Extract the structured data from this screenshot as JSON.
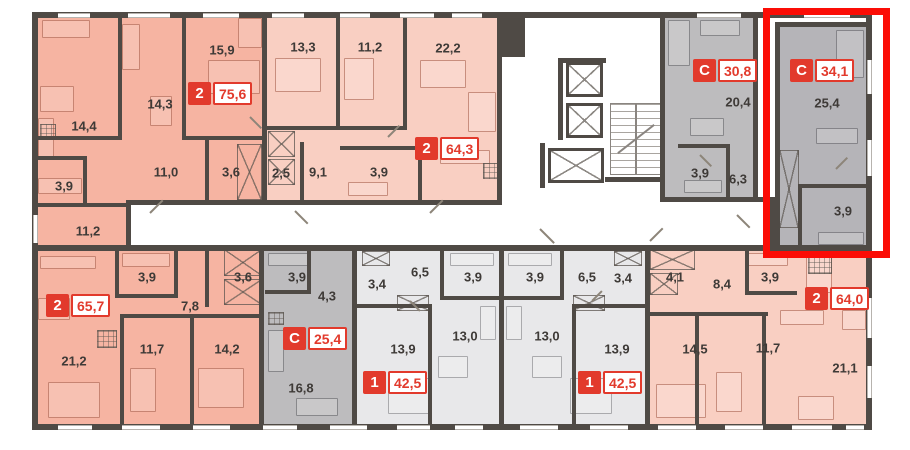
{
  "plan_title": "apartment-floor-plan",
  "palettes": {
    "salmon": "#f6b4a2",
    "pink": "#f9cfc2",
    "gray": "#bdbcbe",
    "gray2": "#b5b4b8",
    "light": "#e8e8ea",
    "wall": "#4f4a45",
    "badge_red": "#e23a2c",
    "highlight_red": "#fb0d06"
  },
  "apartments": [
    {
      "id": "a1",
      "type": "2",
      "area": "75,6",
      "palette": "salmon",
      "regions": [
        {
          "x": 35,
          "y": 15,
          "w": 227,
          "h": 190
        },
        {
          "x": 35,
          "y": 200,
          "w": 91,
          "h": 46
        }
      ],
      "badge": {
        "x": 188,
        "y": 82
      },
      "rooms": [
        {
          "t": "15,9",
          "x": 222,
          "y": 50
        },
        {
          "t": "14,3",
          "x": 160,
          "y": 104
        },
        {
          "t": "14,4",
          "x": 84,
          "y": 126
        },
        {
          "t": "11,0",
          "x": 166,
          "y": 172
        },
        {
          "t": "3,6",
          "x": 231,
          "y": 172
        },
        {
          "t": "3,9",
          "x": 64,
          "y": 186
        },
        {
          "t": "11,2",
          "x": 88,
          "y": 231
        }
      ]
    },
    {
      "id": "a2",
      "type": "2",
      "area": "64,3",
      "palette": "pink",
      "regions": [
        {
          "x": 267,
          "y": 15,
          "w": 230,
          "h": 190
        }
      ],
      "badge": {
        "x": 415,
        "y": 137
      },
      "rooms": [
        {
          "t": "13,3",
          "x": 303,
          "y": 47
        },
        {
          "t": "11,2",
          "x": 370,
          "y": 47
        },
        {
          "t": "22,2",
          "x": 448,
          "y": 48
        },
        {
          "t": "2,5",
          "x": 281,
          "y": 173
        },
        {
          "t": "9,1",
          "x": 318,
          "y": 172
        },
        {
          "t": "3,9",
          "x": 379,
          "y": 172
        }
      ]
    },
    {
      "id": "a3",
      "type": "С",
      "area": "30,8",
      "palette": "gray",
      "regions": [
        {
          "x": 665,
          "y": 15,
          "w": 88,
          "h": 185
        }
      ],
      "badge": {
        "x": 693,
        "y": 59
      },
      "rooms": [
        {
          "t": "20,4",
          "x": 738,
          "y": 102
        },
        {
          "t": "3,9",
          "x": 700,
          "y": 173
        },
        {
          "t": "6,3",
          "x": 738,
          "y": 179
        }
      ]
    },
    {
      "id": "a4",
      "type": "С",
      "area": "34,1",
      "palette": "gray2",
      "regions": [
        {
          "x": 780,
          "y": 27,
          "w": 86,
          "h": 219
        }
      ],
      "badge": {
        "x": 790,
        "y": 59
      },
      "rooms": [
        {
          "t": "25,4",
          "x": 827,
          "y": 103
        },
        {
          "t": "3,9",
          "x": 843,
          "y": 211
        }
      ]
    },
    {
      "id": "a5",
      "type": "2",
      "area": "65,7",
      "palette": "salmon",
      "regions": [
        {
          "x": 35,
          "y": 251,
          "w": 224,
          "h": 173
        }
      ],
      "badge": {
        "x": 46,
        "y": 294
      },
      "rooms": [
        {
          "t": "3,9",
          "x": 147,
          "y": 277
        },
        {
          "t": "3,6",
          "x": 243,
          "y": 277
        },
        {
          "t": "7,8",
          "x": 190,
          "y": 306
        },
        {
          "t": "21,2",
          "x": 74,
          "y": 361
        },
        {
          "t": "11,7",
          "x": 152,
          "y": 349
        },
        {
          "t": "14,2",
          "x": 227,
          "y": 349
        }
      ]
    },
    {
      "id": "a6",
      "type": "С",
      "area": "25,4",
      "palette": "gray",
      "regions": [
        {
          "x": 264,
          "y": 251,
          "w": 88,
          "h": 173
        }
      ],
      "badge": {
        "x": 283,
        "y": 327
      },
      "rooms": [
        {
          "t": "3,9",
          "x": 297,
          "y": 277
        },
        {
          "t": "4,3",
          "x": 327,
          "y": 296
        },
        {
          "t": "16,8",
          "x": 301,
          "y": 388
        }
      ]
    },
    {
      "id": "a7",
      "type": "1",
      "area": "42,5",
      "palette": "light",
      "regions": [
        {
          "x": 357,
          "y": 251,
          "w": 142,
          "h": 173
        }
      ],
      "badge": {
        "x": 363,
        "y": 371
      },
      "rooms": [
        {
          "t": "6,5",
          "x": 420,
          "y": 272
        },
        {
          "t": "3,4",
          "x": 377,
          "y": 284
        },
        {
          "t": "3,9",
          "x": 473,
          "y": 277
        },
        {
          "t": "13,9",
          "x": 403,
          "y": 349
        },
        {
          "t": "13,0",
          "x": 465,
          "y": 336
        }
      ]
    },
    {
      "id": "a8",
      "type": "1",
      "area": "42,5",
      "palette": "light",
      "regions": [
        {
          "x": 504,
          "y": 251,
          "w": 141,
          "h": 173
        }
      ],
      "badge": {
        "x": 578,
        "y": 371
      },
      "rooms": [
        {
          "t": "3,9",
          "x": 535,
          "y": 277
        },
        {
          "t": "6,5",
          "x": 587,
          "y": 277
        },
        {
          "t": "3,4",
          "x": 623,
          "y": 278
        },
        {
          "t": "13,0",
          "x": 547,
          "y": 336
        },
        {
          "t": "13,9",
          "x": 617,
          "y": 349
        }
      ]
    },
    {
      "id": "a9",
      "type": "2",
      "area": "64,0",
      "palette": "pink",
      "regions": [
        {
          "x": 650,
          "y": 251,
          "w": 216,
          "h": 173
        }
      ],
      "badge": {
        "x": 805,
        "y": 287
      },
      "rooms": [
        {
          "t": "4,1",
          "x": 675,
          "y": 277
        },
        {
          "t": "8,4",
          "x": 722,
          "y": 284
        },
        {
          "t": "3,9",
          "x": 770,
          "y": 277
        },
        {
          "t": "14,5",
          "x": 695,
          "y": 349
        },
        {
          "t": "11,7",
          "x": 768,
          "y": 348
        },
        {
          "t": "21,1",
          "x": 845,
          "y": 368
        }
      ]
    }
  ],
  "highlight": {
    "x": 763,
    "y": 8,
    "w": 127,
    "h": 250
  },
  "core": {
    "elevators": [
      [
        566,
        62,
        37,
        35
      ],
      [
        566,
        103,
        37,
        35
      ],
      [
        548,
        148,
        56,
        35
      ]
    ],
    "stairs": [
      610,
      103,
      52,
      72
    ]
  },
  "walls": [
    [
      32,
      12,
      840,
      6
    ],
    [
      32,
      424,
      840,
      6
    ],
    [
      32,
      12,
      6,
      418
    ],
    [
      866,
      12,
      6,
      418
    ],
    [
      128,
      200,
      374,
      5
    ],
    [
      662,
      197,
      115,
      5
    ],
    [
      32,
      245,
      840,
      6
    ],
    [
      126,
      200,
      5,
      50
    ],
    [
      770,
      197,
      6,
      54
    ],
    [
      262,
      12,
      5,
      193
    ],
    [
      497,
      12,
      5,
      193
    ],
    [
      660,
      12,
      5,
      190
    ],
    [
      753,
      12,
      5,
      190
    ],
    [
      775,
      22,
      5,
      229
    ],
    [
      775,
      22,
      93,
      5
    ],
    [
      259,
      251,
      5,
      173
    ],
    [
      352,
      251,
      5,
      173
    ],
    [
      499,
      251,
      5,
      173
    ],
    [
      645,
      251,
      5,
      173
    ],
    [
      118,
      12,
      4,
      128
    ],
    [
      182,
      12,
      4,
      128
    ],
    [
      35,
      136,
      85,
      4
    ],
    [
      182,
      136,
      82,
      4
    ],
    [
      35,
      156,
      52,
      4
    ],
    [
      83,
      156,
      4,
      50
    ],
    [
      35,
      203,
      93,
      4
    ],
    [
      205,
      140,
      4,
      64
    ],
    [
      336,
      12,
      4,
      118
    ],
    [
      403,
      12,
      4,
      118
    ],
    [
      267,
      126,
      140,
      4
    ],
    [
      300,
      142,
      4,
      62
    ],
    [
      340,
      146,
      82,
      4
    ],
    [
      418,
      146,
      4,
      58
    ],
    [
      678,
      144,
      50,
      4
    ],
    [
      726,
      144,
      4,
      55
    ],
    [
      798,
      184,
      70,
      4
    ],
    [
      798,
      184,
      4,
      64
    ],
    [
      115,
      251,
      4,
      47
    ],
    [
      115,
      294,
      62,
      4
    ],
    [
      174,
      251,
      4,
      47
    ],
    [
      205,
      251,
      4,
      56
    ],
    [
      120,
      314,
      142,
      4
    ],
    [
      120,
      318,
      4,
      108
    ],
    [
      190,
      318,
      4,
      108
    ],
    [
      265,
      290,
      46,
      4
    ],
    [
      307,
      251,
      4,
      42
    ],
    [
      440,
      251,
      4,
      49
    ],
    [
      440,
      296,
      62,
      4
    ],
    [
      428,
      308,
      4,
      118
    ],
    [
      355,
      304,
      77,
      4
    ],
    [
      560,
      251,
      4,
      49
    ],
    [
      502,
      296,
      62,
      4
    ],
    [
      572,
      308,
      4,
      118
    ],
    [
      572,
      304,
      77,
      4
    ],
    [
      745,
      251,
      4,
      44
    ],
    [
      745,
      291,
      52,
      4
    ],
    [
      695,
      316,
      4,
      110
    ],
    [
      762,
      316,
      4,
      110
    ],
    [
      648,
      312,
      120,
      4
    ],
    [
      497,
      15,
      28,
      42
    ],
    [
      558,
      58,
      5,
      82
    ],
    [
      558,
      58,
      48,
      5
    ],
    [
      540,
      143,
      5,
      45
    ],
    [
      605,
      177,
      60,
      5
    ]
  ],
  "windows_top": [
    [
      58,
      32
    ],
    [
      128,
      42
    ],
    [
      203,
      36
    ],
    [
      272,
      32
    ],
    [
      340,
      30
    ],
    [
      400,
      34
    ],
    [
      452,
      30
    ],
    [
      697,
      44
    ],
    [
      804,
      46
    ]
  ],
  "windows_bottom": [
    [
      58,
      34
    ],
    [
      122,
      38
    ],
    [
      193,
      37
    ],
    [
      263,
      34
    ],
    [
      330,
      37
    ],
    [
      397,
      33
    ],
    [
      455,
      28
    ],
    [
      520,
      38
    ],
    [
      590,
      38
    ],
    [
      658,
      38
    ],
    [
      725,
      38
    ],
    [
      792,
      40
    ],
    [
      846,
      18
    ]
  ],
  "windows_left": [
    [
      215,
      28
    ]
  ],
  "windows_right": [
    [
      60,
      34
    ],
    [
      140,
      36
    ],
    [
      298,
      40
    ],
    [
      366,
      32
    ]
  ],
  "furniture": [
    [
      42,
      20,
      48,
      18,
      "p"
    ],
    [
      238,
      18,
      24,
      30,
      "p"
    ],
    [
      208,
      60,
      52,
      34,
      "p"
    ],
    [
      122,
      24,
      18,
      46,
      "p"
    ],
    [
      40,
      86,
      34,
      26,
      "p"
    ],
    [
      38,
      118,
      16,
      40,
      "p"
    ],
    [
      150,
      96,
      22,
      30,
      "p"
    ],
    [
      38,
      178,
      44,
      16,
      "p"
    ],
    [
      275,
      58,
      46,
      34,
      "p"
    ],
    [
      344,
      58,
      30,
      42,
      "p"
    ],
    [
      420,
      60,
      46,
      28,
      "p"
    ],
    [
      468,
      92,
      28,
      40,
      "p"
    ],
    [
      440,
      150,
      50,
      14,
      "p"
    ],
    [
      348,
      182,
      40,
      14,
      "p"
    ],
    [
      668,
      20,
      22,
      46,
      "g"
    ],
    [
      700,
      20,
      40,
      16,
      "g"
    ],
    [
      690,
      118,
      34,
      18,
      "g"
    ],
    [
      684,
      180,
      38,
      13,
      "g"
    ],
    [
      836,
      30,
      28,
      48,
      "g"
    ],
    [
      816,
      128,
      42,
      16,
      "g"
    ],
    [
      818,
      232,
      46,
      13,
      "g"
    ],
    [
      40,
      256,
      56,
      13,
      "p"
    ],
    [
      122,
      253,
      48,
      14,
      "p"
    ],
    [
      38,
      298,
      32,
      22,
      "p"
    ],
    [
      48,
      382,
      52,
      36,
      "p"
    ],
    [
      130,
      368,
      26,
      44,
      "p"
    ],
    [
      198,
      368,
      46,
      40,
      "p"
    ],
    [
      268,
      253,
      40,
      13,
      "g"
    ],
    [
      268,
      330,
      16,
      42,
      "g"
    ],
    [
      296,
      398,
      42,
      18,
      "g"
    ],
    [
      450,
      253,
      44,
      13,
      "l"
    ],
    [
      388,
      378,
      42,
      36,
      "l"
    ],
    [
      480,
      306,
      16,
      34,
      "l"
    ],
    [
      438,
      356,
      30,
      22,
      "l"
    ],
    [
      508,
      253,
      44,
      13,
      "l"
    ],
    [
      570,
      378,
      42,
      36,
      "l"
    ],
    [
      506,
      306,
      16,
      34,
      "l"
    ],
    [
      532,
      356,
      30,
      22,
      "l"
    ],
    [
      748,
      253,
      40,
      13,
      "p"
    ],
    [
      806,
      253,
      26,
      40,
      "p"
    ],
    [
      780,
      310,
      44,
      15,
      "p"
    ],
    [
      656,
      384,
      50,
      34,
      "p"
    ],
    [
      716,
      372,
      26,
      40,
      "p"
    ],
    [
      798,
      396,
      36,
      24,
      "p"
    ],
    [
      842,
      310,
      24,
      20,
      "p"
    ]
  ],
  "xboxes": [
    [
      237,
      144,
      25,
      56
    ],
    [
      268,
      131,
      27,
      26
    ],
    [
      268,
      159,
      27,
      26
    ],
    [
      779,
      150,
      20,
      78
    ],
    [
      224,
      249,
      38,
      27
    ],
    [
      224,
      279,
      38,
      26
    ],
    [
      362,
      251,
      28,
      15
    ],
    [
      397,
      295,
      32,
      16
    ],
    [
      614,
      251,
      28,
      15
    ],
    [
      573,
      295,
      32,
      16
    ],
    [
      650,
      249,
      45,
      21
    ],
    [
      650,
      273,
      28,
      22
    ]
  ],
  "hatches": [
    [
      40,
      124,
      16,
      16
    ],
    [
      483,
      163,
      18,
      16
    ],
    [
      97,
      330,
      20,
      18
    ],
    [
      268,
      312,
      16,
      13
    ],
    [
      808,
      256,
      24,
      18
    ]
  ],
  "doors": [
    [
      150,
      212,
      18,
      -45
    ],
    [
      295,
      210,
      18,
      45
    ],
    [
      430,
      212,
      18,
      -45
    ],
    [
      540,
      228,
      20,
      45
    ],
    [
      650,
      240,
      18,
      -45
    ],
    [
      737,
      214,
      18,
      45
    ],
    [
      250,
      116,
      16,
      45
    ],
    [
      388,
      136,
      16,
      -45
    ],
    [
      700,
      154,
      16,
      45
    ],
    [
      836,
      168,
      16,
      -45
    ],
    [
      410,
      300,
      14,
      45
    ],
    [
      592,
      300,
      14,
      -45
    ]
  ]
}
